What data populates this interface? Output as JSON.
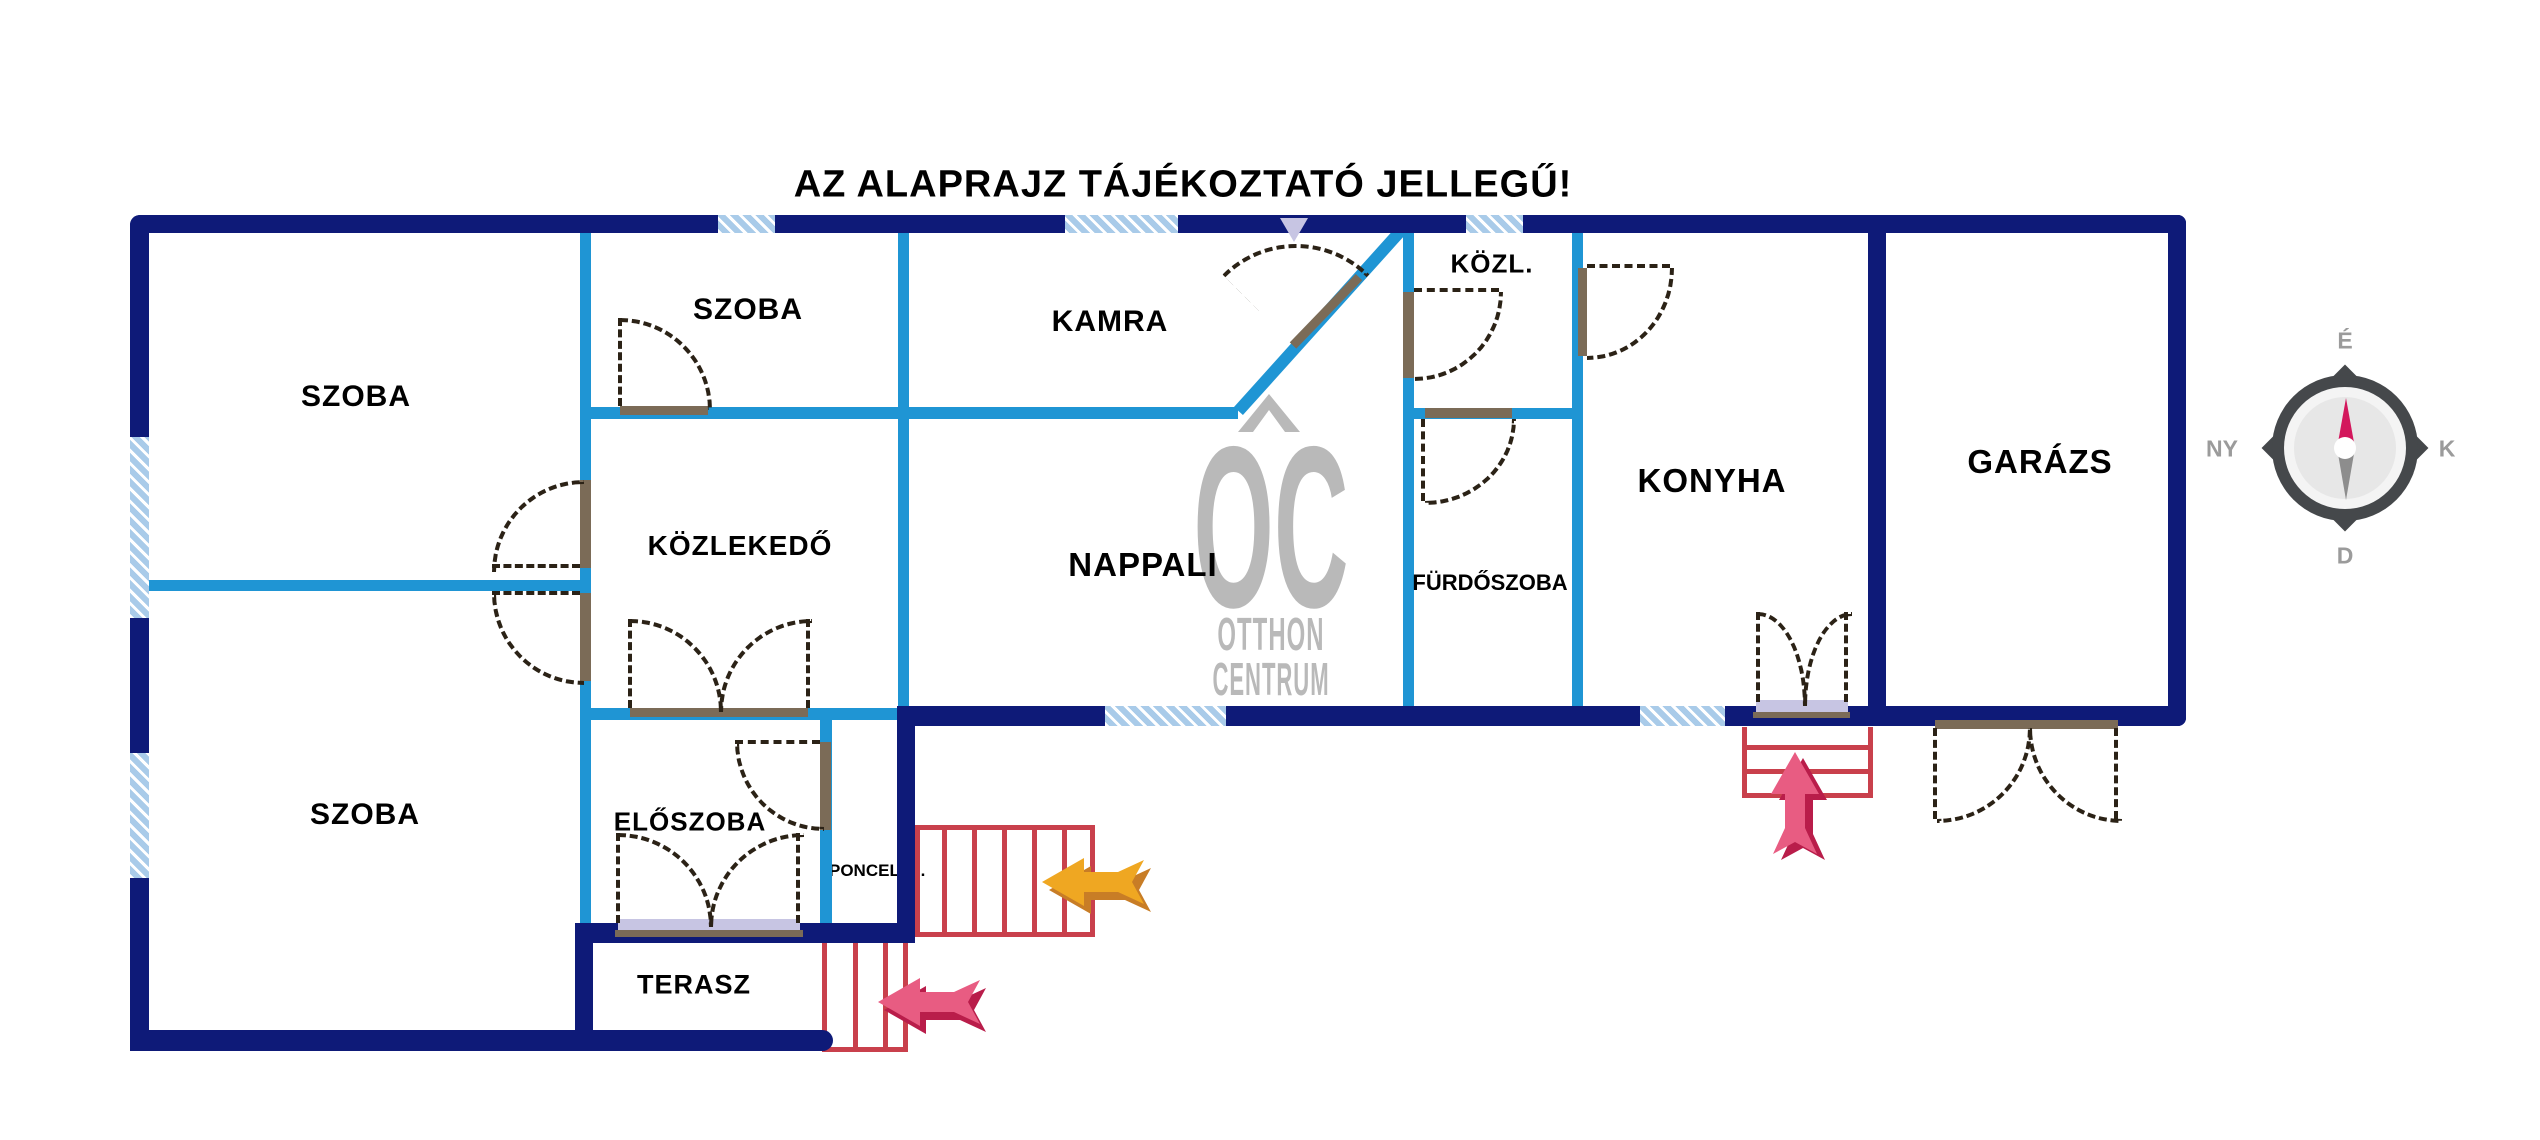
{
  "title": "AZ ALAPRAJZ TÁJÉKOZTATÓ JELLEGŰ!",
  "rooms": {
    "szoba_nw": "SZOBA",
    "szoba_n": "SZOBA",
    "kamra": "KAMRA",
    "kozl": "KÖZL.",
    "kozlekedo": "KÖZLEKEDŐ",
    "nappali": "NAPPALI",
    "furdoszoba": "FÜRDŐSZOBA",
    "konyha": "KONYHA",
    "garazs": "GARÁZS",
    "szoba_sw": "SZOBA",
    "eloszoba": "ELŐSZOBA",
    "terasz": "TERASZ",
    "pince_label": "PONCELEJ."
  },
  "watermark": {
    "initials": "OC",
    "line1": "OTTHON",
    "line2": "CENTRUM"
  },
  "compass": {
    "north": "É",
    "east": "K",
    "south": "D",
    "west": "NY"
  },
  "colors": {
    "outer_wall": "#0e1a78",
    "inner_wall": "#1f95d4",
    "window_fill": "#a9cbe9",
    "stair_red": "#c9404c",
    "arrow_orange": "#efa722",
    "arrow_orange_shadow": "#c87d26",
    "arrow_pink": "#e85c82",
    "arrow_pink_shadow": "#b91d4a",
    "door_leaf": "#7b6b57",
    "door_sill": "#c7c5e3",
    "watermark_gray": "#b9b9b9",
    "compass_dark": "#45484b",
    "compass_needle_red": "#d3175c"
  }
}
